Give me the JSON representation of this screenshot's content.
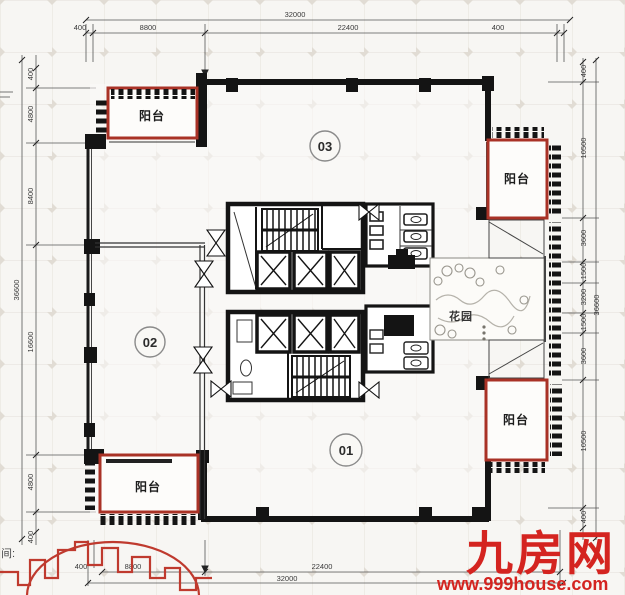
{
  "colors": {
    "balcony_red": "#a93226",
    "watermark_red": "#d42420",
    "skyline_red": "#bf3a2e",
    "wall_black": "#161616"
  },
  "plan": {
    "balcony": "阳台",
    "garden": "花园",
    "unit_labels": [
      "03",
      "02",
      "01"
    ],
    "corner_note": "间:"
  },
  "dims": {
    "top": {
      "total": "32000",
      "segments": [
        "400",
        "8800",
        "22400",
        "400"
      ]
    },
    "bottom": {
      "total": "32000",
      "segments": [
        "400",
        "8800",
        "22400"
      ]
    },
    "left": {
      "total": "36600",
      "segments": [
        "400",
        "4800",
        "8400",
        "16600",
        "4800",
        "400"
      ]
    },
    "right": {
      "total": "36600",
      "segments": [
        "400",
        "10500",
        "3600",
        "1500",
        "3200",
        "1500",
        "3600",
        "10500",
        "400"
      ]
    }
  },
  "watermark": {
    "brand": "九房网",
    "url": "www.999house.com"
  }
}
